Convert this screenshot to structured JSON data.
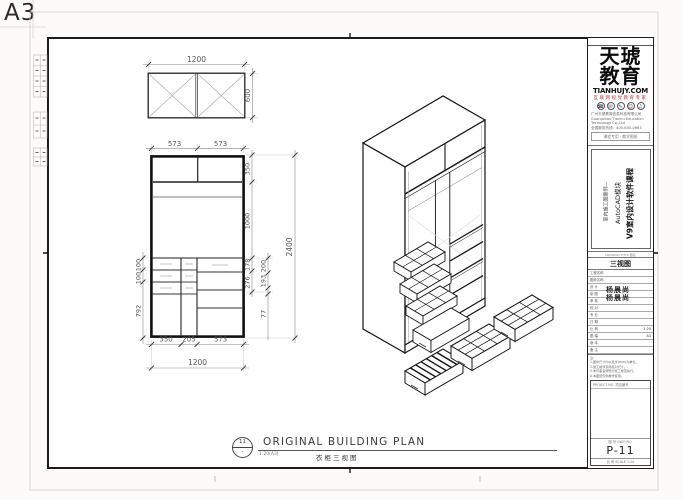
{
  "sheet": {
    "size": "A3"
  },
  "dims": {
    "plan_w": "1200",
    "plan_d": "600",
    "el_top1": "573",
    "el_top2": "573",
    "el_l1": "100",
    "el_l2": "100",
    "el_l3": "792",
    "el_r1": "350",
    "el_r2": "1000",
    "el_r3": "178",
    "el_r4": "276",
    "el_r5": "200",
    "el_r6": "193",
    "el_r7": "77",
    "el_h": "2400",
    "el_b1": "350",
    "el_b2": "205",
    "el_b3": "573",
    "el_w": "1200"
  },
  "footer": {
    "marker_no": "11",
    "marker_sub": "-",
    "title": "ORIGINAL BUILDING PLAN",
    "scale": "1:20(A3)",
    "subtitle": "衣柜三视图"
  },
  "title_block": {
    "logo_line1": "天琥",
    "logo_line2": "教育",
    "domain": "TIANHUJY.COM",
    "tagline": "互联网视觉教育专家",
    "company_lines": [
      "广州天琥教育信息科技有限公司",
      "Guangzhou Tianhu Education Technology Co.,Ltd",
      "全国服务热线：400-600-0663"
    ],
    "stamp": "课程专用 · 教学图纸",
    "icons": [
      "☎",
      "✉",
      "✎",
      "☺",
      "♫"
    ],
    "course_title": "V9室内设计软件课程",
    "course_module": "AutoCAD模块",
    "course_case": "室内施工图案例—",
    "name_label": "DRAWING TITLE 图名",
    "sheet_name": "三视图",
    "rows": [
      {
        "label": "工程名称",
        "value": ""
      },
      {
        "label": "图纸名称",
        "value": ""
      },
      {
        "label": "设 计",
        "value": ""
      },
      {
        "label": "制 图",
        "value": ""
      },
      {
        "label": "审 核",
        "value": ""
      },
      {
        "label": "校 对",
        "value": ""
      },
      {
        "label": "专 业",
        "value": ""
      },
      {
        "label": "日 期",
        "value": ""
      },
      {
        "label": "比 例",
        "value": "1:20"
      },
      {
        "label": "图 幅",
        "value": "A3"
      },
      {
        "label": "版 本",
        "value": ""
      },
      {
        "label": "备 注",
        "value": ""
      }
    ],
    "stamp_name1": "杨晨尚",
    "stamp_name2": "杨晨尚",
    "notes": [
      "注:",
      "1.图中尺寸均以毫米(mm)为单位。",
      "2.施工前须现场核对尺寸。",
      "3.未尽事宜按现行施工规范执行。",
      "4.本图纸仅供教学使用。"
    ],
    "no_header": "PROJECT NO. 项目编号",
    "no_label": "图 号 DWG NO.",
    "number": "P-11",
    "scale_line": "比 例 SCALE 1:20"
  }
}
